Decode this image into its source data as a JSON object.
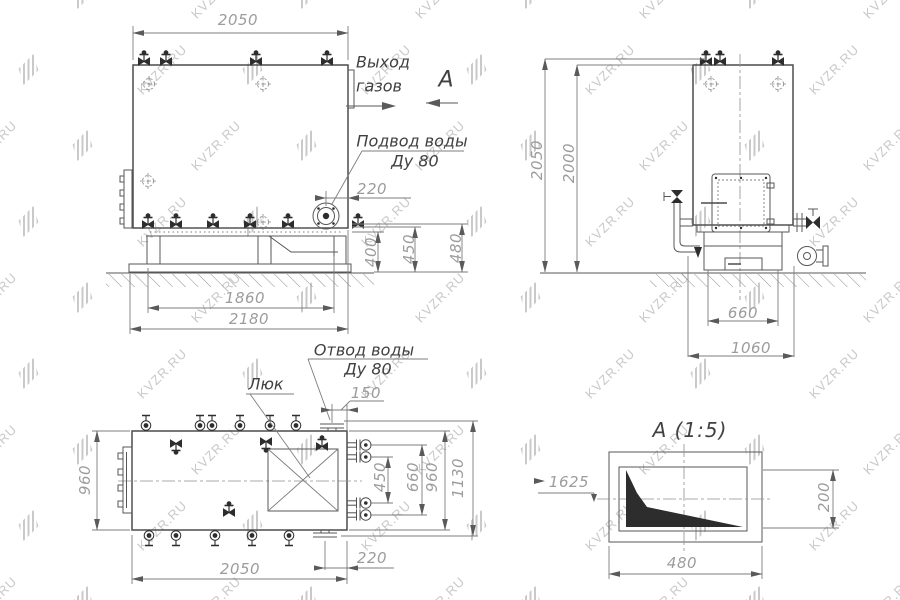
{
  "watermark": {
    "text": "KVZR.RU",
    "color": "#c9c9c9"
  },
  "colors": {
    "line": "#4c4c4c",
    "dim_text": "#9c9c9c",
    "label_text": "#414141",
    "background": "#ffffff"
  },
  "front_view": {
    "dim_width_top": "2050",
    "label_gas_outlet_line1": "Выход",
    "label_gas_outlet_line2": "газов",
    "section_arrow_label": "А",
    "label_water_inlet_line1": "Подвод воды",
    "label_water_inlet_line2": "Ду 80",
    "dim_inlet_offset": "220",
    "dim_height_400": "400",
    "dim_height_450": "450",
    "dim_height_480": "480",
    "dim_frame_1860": "1860",
    "dim_frame_2180": "2180"
  },
  "side_view": {
    "dim_height_2050": "2050",
    "dim_height_2000": "2000",
    "dim_base_660": "660",
    "dim_base_1060": "1060"
  },
  "top_view": {
    "label_water_outlet_line1": "Отвод воды",
    "label_water_outlet_line2": "Ду 80",
    "label_hatch": "Люк",
    "dim_outlet_150": "150",
    "dim_nozzles_450": "450",
    "dim_nozzles_660": "660",
    "dim_width_960_right": "960",
    "dim_overall_1130": "1130",
    "dim_body_960_left": "960",
    "dim_outlet_220": "220",
    "dim_length_2050": "2050"
  },
  "detail_view": {
    "title": "А  (1:5)",
    "dim_position_1625": "1625",
    "dim_height_200": "200",
    "dim_width_480": "480"
  }
}
